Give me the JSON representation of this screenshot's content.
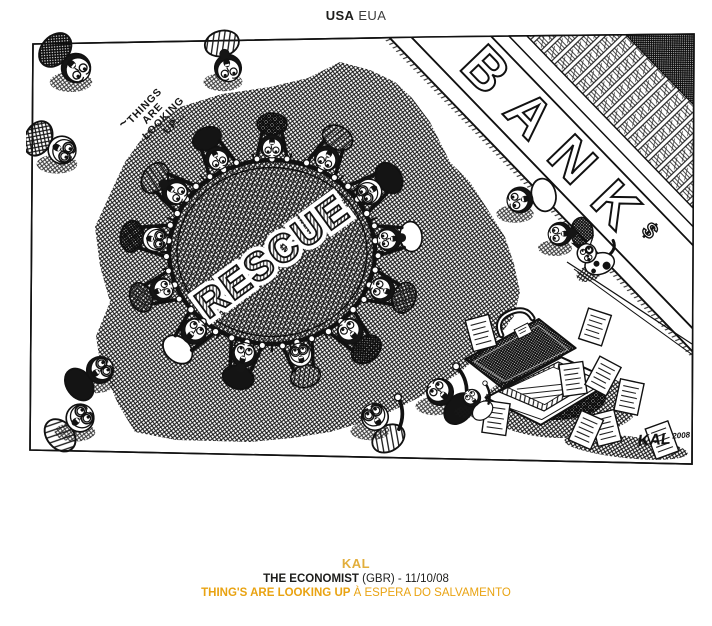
{
  "header": {
    "country_primary": "USA",
    "country_secondary": "EUA"
  },
  "cartoon": {
    "speech_lines": [
      "THINGS",
      "ARE",
      "LOOKING",
      "UP..."
    ],
    "speech_squiggle": "~",
    "trampoline_label": "RESCUE",
    "bank_label": "BANK",
    "bank_symbol": "$",
    "signature": "KAL",
    "signature_year": "2008"
  },
  "footer": {
    "author": "KAL",
    "publication": "THE ECONOMIST",
    "publication_detail": "(GBR) - 11/10/08",
    "title": "THING'S ARE LOOKING UP",
    "subtitle": "À ESPERA DO SALVAMENTO"
  },
  "colors": {
    "accent_gold": "#E9A312",
    "accent_gold_light": "#E2AE3B",
    "ink": "#111111",
    "text_dark": "#1D1D1B"
  }
}
